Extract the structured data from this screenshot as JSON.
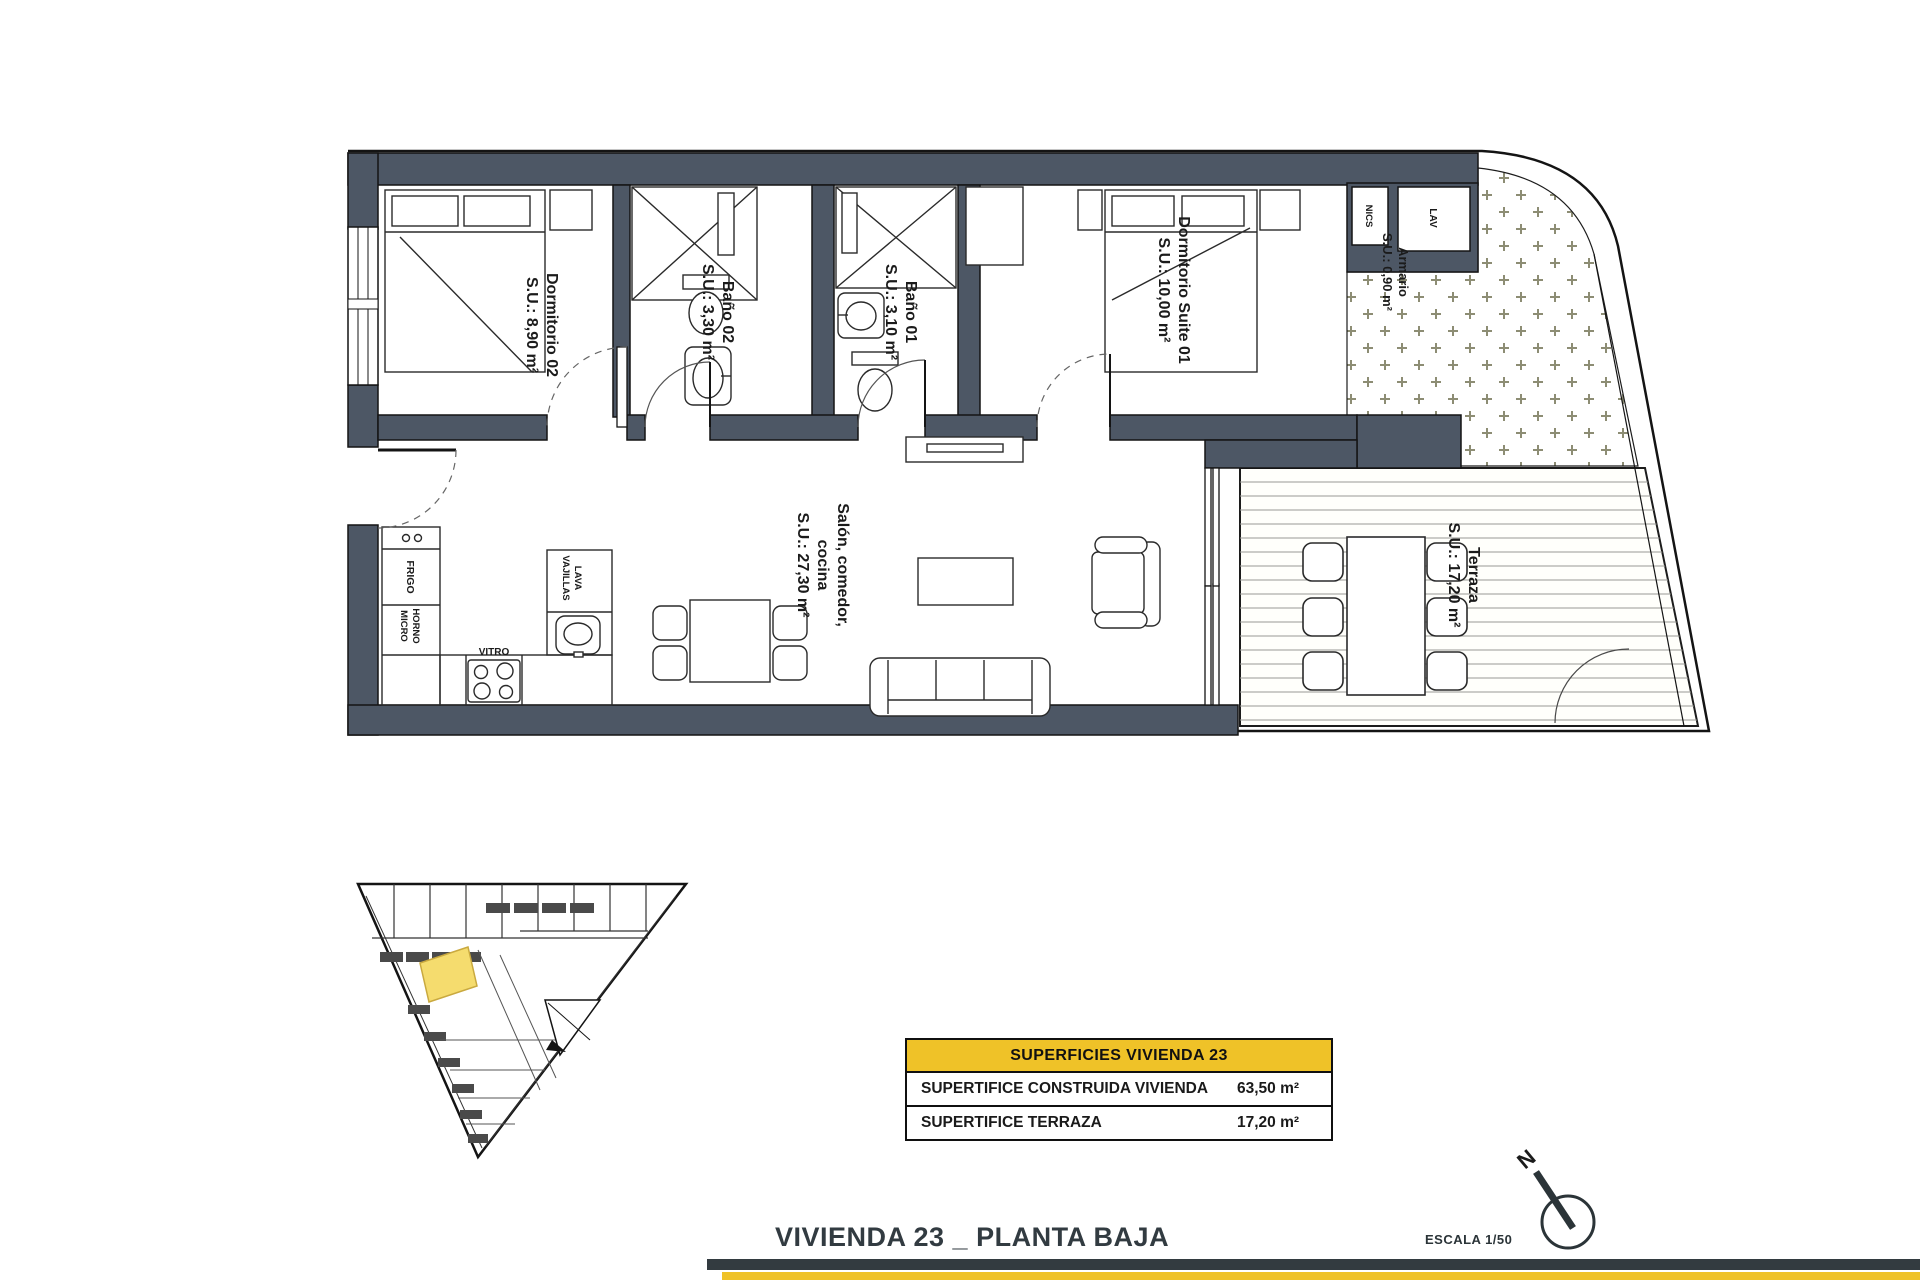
{
  "plan": {
    "rooms": {
      "dormitorio02": {
        "name": "Dormitorio 02",
        "area": "S.U.: 8,90 m²"
      },
      "bano02": {
        "name": "Baño 02",
        "area": "S.U.: 3,30 m²"
      },
      "bano01": {
        "name": "Baño 01",
        "area": "S.U.: 3,10 m²"
      },
      "suite01": {
        "name": "Dormitorio Suite 01",
        "area": "S.U.: 10,00 m²"
      },
      "armario": {
        "name": "Armario",
        "area": "S.U.: 0,90 m²"
      },
      "salon": {
        "line1": "Salón, comedor,",
        "line2": "cocina",
        "area": "S.U.: 27,30 m²"
      },
      "terraza": {
        "name": "Terraza",
        "area": "S.U.: 17,20 m²"
      }
    },
    "appliances": {
      "frigo": "FRIGO",
      "horno": "HORNO",
      "micro": "MICRO",
      "vitro": "VITRO",
      "lava": "LAVA",
      "vajillas": "VAJILLAS",
      "lav": "LAV",
      "nics": "NICS"
    }
  },
  "summary_table": {
    "header": "SUPERFICIES VIVIENDA 23",
    "rows": [
      {
        "label": "SUPERTIFICE CONSTRUIDA VIVIENDA",
        "value": "63,50 m²"
      },
      {
        "label": "SUPERTIFICE TERRAZA",
        "value": "17,20 m²"
      }
    ]
  },
  "footer": {
    "title": "VIVIENDA 23 _ PLANTA BAJA",
    "scale": "ESCALA 1/50",
    "north": "N"
  },
  "colors": {
    "wall": "#4d5765",
    "accent_yellow": "#efc228",
    "bar_dark": "#333b40",
    "site_highlight": "#f5dc6e"
  }
}
